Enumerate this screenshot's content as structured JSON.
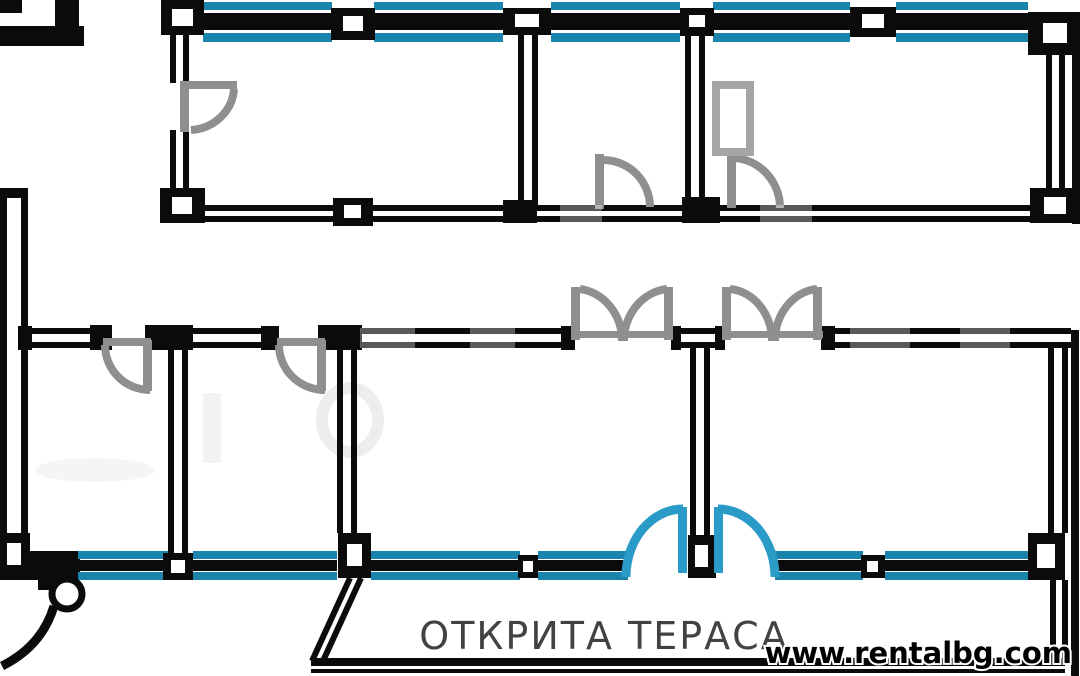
{
  "document": {
    "kind_label": "apartment floor plan drawing",
    "labels": {
      "open_terrace": "ОТКРИТА ТЕРАСА"
    },
    "branding": {
      "url": "www.rentalbg.com"
    }
  },
  "colors": {
    "bg": "#ffffff",
    "wall": "#0b0b0b",
    "door": "#8f8f8f",
    "win": "#1b84ad",
    "tdoor": "#2a9bc7",
    "tx": "#424242"
  }
}
